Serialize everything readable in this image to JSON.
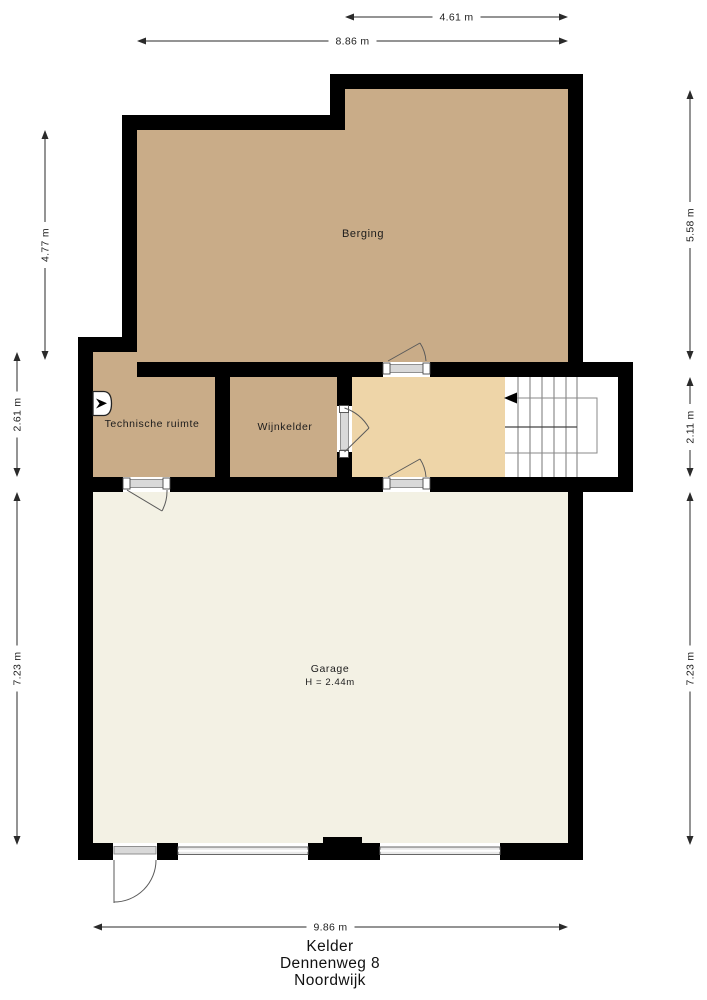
{
  "plan": {
    "colors": {
      "wall": "#000000",
      "room_tan": "#c9ac88",
      "hall": "#eed5a8",
      "stairwell": "#ffffff",
      "garage_floor": "#f3f1e4"
    },
    "rooms": [
      {
        "name": "Berging"
      },
      {
        "name": "Technische ruimte"
      },
      {
        "name": "Wijnkelder"
      },
      {
        "name": "Garage",
        "height_note": "H = 2.44m"
      }
    ],
    "dimensions": {
      "top_partial": "4.61 m",
      "top_full": "8.86 m",
      "left_upper": "4.77 m",
      "left_middle": "2.61 m",
      "left_lower": "7.23 m",
      "right_upper": "5.58 m",
      "right_middle": "2.11 m",
      "right_lower": "7.23 m",
      "bottom": "9.86 m"
    }
  },
  "footer": {
    "floor_name": "Kelder",
    "address_line1": "Dennenweg 8",
    "address_line2": "Noordwijk"
  }
}
